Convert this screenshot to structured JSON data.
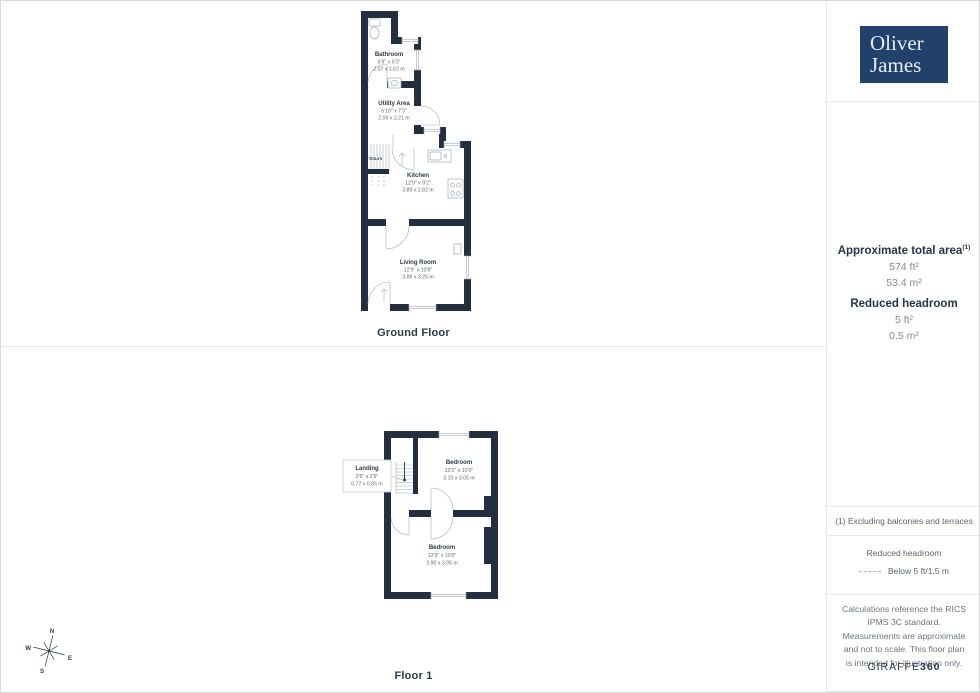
{
  "brand": {
    "line1": "Oliver",
    "line2": "James"
  },
  "sidebar": {
    "area": {
      "title": "Approximate total area",
      "title_sup": "(1)",
      "sqft": "574 ft²",
      "sqm": "53.4 m²",
      "headroom_title": "Reduced headroom",
      "headroom_sqft": "5 ft²",
      "headroom_sqm": "0.5 m²"
    },
    "footnote": "(1) Excluding balconies and terraces",
    "legend": {
      "title": "Reduced headroom",
      "item": "Below 5 ft/1.5 m"
    },
    "disclaimer": "Calculations reference the RICS IPMS 3C standard. Measurements are approximate and not to scale. This floor plan is intended for illustration only.",
    "credit": {
      "brand": "GIRAFFE",
      "suffix": "360"
    }
  },
  "ground_floor": {
    "label": "Ground Floor",
    "stairs": "Stairs",
    "rooms": {
      "bathroom": {
        "name": "Bathroom",
        "imperial": "6'9\" x 5'3\"",
        "metric": "2.07 x 1.62 m"
      },
      "utility": {
        "name": "Utility Area",
        "imperial": "6'10\" x 7'3\"",
        "metric": "2.09 x 2.21 m"
      },
      "kitchen": {
        "name": "Kitchen",
        "imperial": "12'9\" x 9'2\"",
        "metric": "3.89 x 2.82 m"
      },
      "living": {
        "name": "Living Room",
        "imperial": "12'9\" x 10'8\"",
        "metric": "3.89 x 3.25 m"
      }
    }
  },
  "floor1": {
    "label": "Floor 1",
    "rooms": {
      "bedroom1": {
        "name": "Bedroom",
        "imperial": "10'2\" x 10'0\"",
        "metric": "3.10 x 3.05 m"
      },
      "bedroom2": {
        "name": "Bedroom",
        "imperial": "12'9\" x 10'0\"",
        "metric": "3.90 x 3.05 m"
      },
      "landing": {
        "name": "Landing",
        "imperial": "2'6\" x 2'9\"",
        "metric": "0.77 x 0.85 m"
      }
    }
  },
  "compass": {
    "n": "N",
    "e": "E",
    "s": "S",
    "w": "W"
  },
  "colors": {
    "wall": "#232f3e",
    "logo_bg": "#21406b"
  }
}
